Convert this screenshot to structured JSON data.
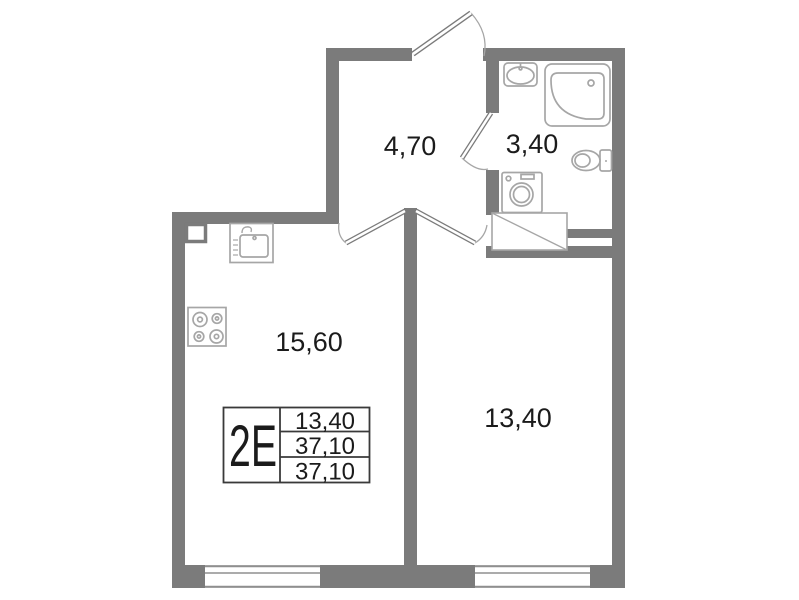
{
  "unit": {
    "type_label": "2E",
    "spec_rows": [
      {
        "value": "13,40"
      },
      {
        "value": "37,10"
      },
      {
        "value": "37,10"
      }
    ]
  },
  "rooms": [
    {
      "name": "hallway",
      "area": "4,70"
    },
    {
      "name": "bathroom",
      "area": "3,40"
    },
    {
      "name": "kitchen-living-room",
      "area": "15,60"
    },
    {
      "name": "bedroom",
      "area": "13,40"
    }
  ],
  "fixtures": [
    "bathroom-sink-icon",
    "corner-bathtub-icon",
    "toilet-icon",
    "washing-machine-icon",
    "duct-hatch-icon",
    "kitchen-sink-icon",
    "stove-icon"
  ],
  "colors": {
    "wall": "#7b7b7b",
    "fixture_outline": "#a6a6a6",
    "door": "#7b7b7b",
    "arc": "#a6a6a6",
    "window_line": "#8f8f8f",
    "text": "#1b1b1b",
    "table_border": "#3a3a3a",
    "background": "#ffffff"
  }
}
